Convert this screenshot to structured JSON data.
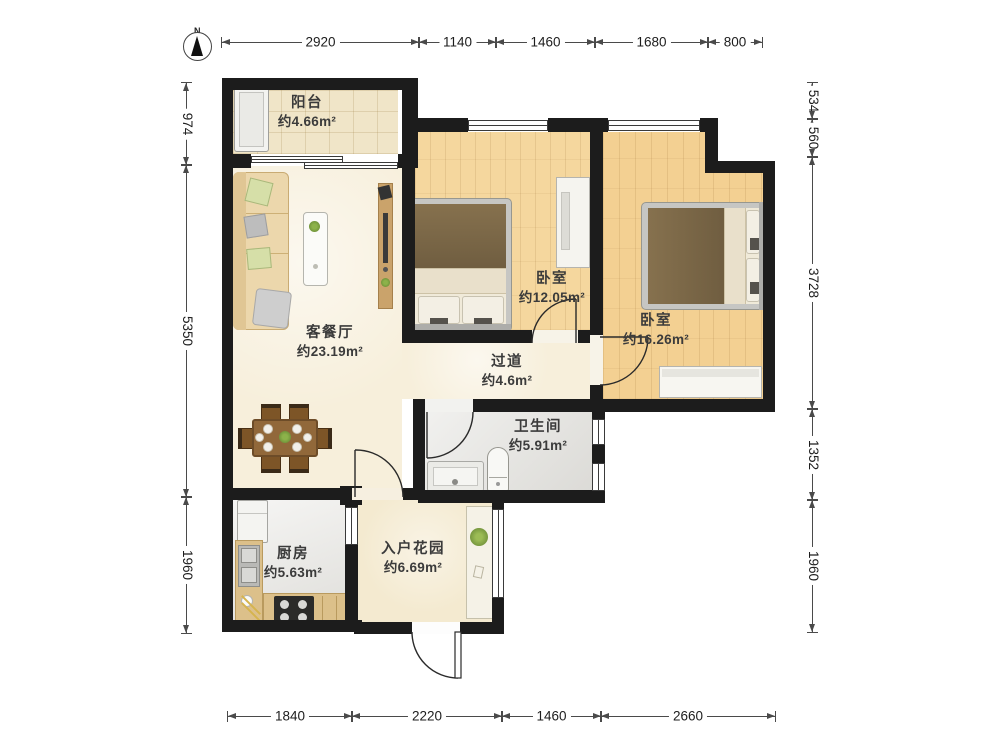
{
  "north": {
    "label": "N"
  },
  "rooms": {
    "balcony": {
      "name": "阳台",
      "area": "约4.66m²"
    },
    "living": {
      "name": "客餐厅",
      "area": "约23.19m²"
    },
    "bedroom1": {
      "name": "卧室",
      "area": "约12.05m²"
    },
    "bedroom2": {
      "name": "卧室",
      "area": "约16.26m²"
    },
    "hallway": {
      "name": "过道",
      "area": "约4.6m²"
    },
    "bathroom": {
      "name": "卫生间",
      "area": "约5.91m²"
    },
    "kitchen": {
      "name": "厨房",
      "area": "约5.63m²"
    },
    "garden": {
      "name": "入户花园",
      "area": "约6.69m²"
    }
  },
  "dimensions": {
    "top": [
      "2920",
      "1140",
      "1460",
      "1680",
      "800"
    ],
    "bottom": [
      "1840",
      "2220",
      "1460",
      "2660"
    ],
    "left": [
      "974",
      "5350",
      "1960"
    ],
    "right": [
      "534",
      "560",
      "3728",
      "1352",
      "1960"
    ]
  },
  "colors": {
    "wall": "#1c1c1c",
    "dim_line": "#4a4a4a",
    "label_text": "#3b3b3b",
    "wood_floor_1": "#f5d79e",
    "wood_floor_2": "#f3d092",
    "cream_floor": "#f7efdb",
    "garden_floor": "#f4ead0",
    "tile_floor": "#f0e5c8",
    "bath_floor": "#e3e2de",
    "kitchen_floor": "#e9e8e4",
    "counter_tan": "#dcc08a",
    "blanket_brown": "#7e6a49",
    "table_brown": "#91683a",
    "plant_green": "#7da23f"
  }
}
